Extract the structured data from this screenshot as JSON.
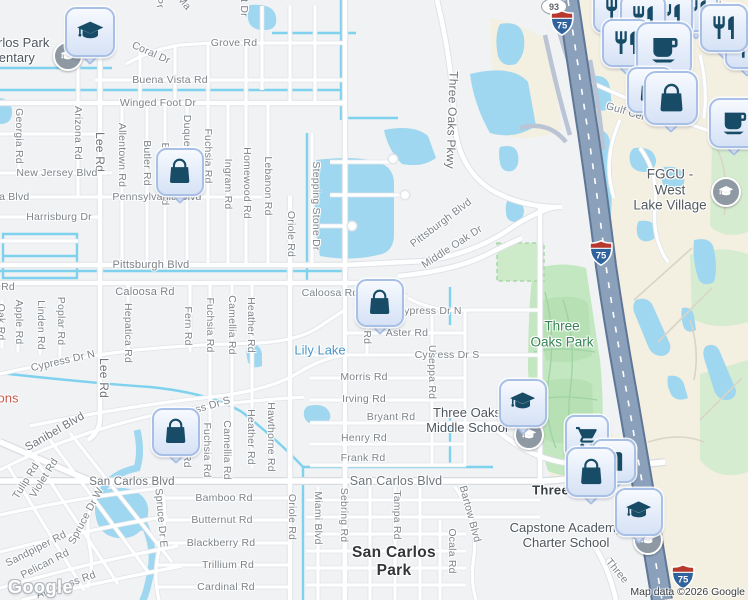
{
  "map": {
    "attribution": "Map data ©2026 Google",
    "watermark": "Google",
    "colors": {
      "land": "#f0f2f4",
      "commercial": "#f3efe1",
      "water": "#9ed7ef",
      "canal": "#7fd2ee",
      "park": "#c3e7c0",
      "golf": "#d6ecd0",
      "highway": "#8ba0ba",
      "highway_edge": "#5f7796",
      "pin_bg": "#e4ecfa",
      "pin_border": "#a9c0e6",
      "pin_icon": "#174b66",
      "road_label": "#7d848a",
      "park_label": "#3a8257",
      "water_label": "#4a96c8"
    },
    "place_labels": [
      {
        "name": "san-carlos-park-elementary-label",
        "lines": [
          "San Carlos Park",
          "Elementary"
        ],
        "x": 2,
        "y": 51,
        "color": "#4e565e",
        "size": 13
      },
      {
        "name": "fgcu-west-lake-village-label",
        "lines": [
          "FGCU - West",
          "Lake Village"
        ],
        "x": 670,
        "y": 190,
        "color": "#545b61",
        "size": 13.5
      },
      {
        "name": "three-oaks-park-label",
        "lines": [
          "Three",
          "Oaks Park"
        ],
        "x": 562,
        "y": 334,
        "color": "#3a8257",
        "size": 13.5
      },
      {
        "name": "lily-lake-label",
        "lines": [
          "Lily Lake"
        ],
        "x": 320,
        "y": 351,
        "color": "#4a96c8",
        "size": 13
      },
      {
        "name": "three-oaks-middle-school-label",
        "lines": [
          "Three Oaks",
          "Middle School"
        ],
        "x": 467,
        "y": 421,
        "color": "#4e565e",
        "size": 13
      },
      {
        "name": "capstone-academy-charter-school-label",
        "lines": [
          "Capstone Academy",
          "Charter School"
        ],
        "x": 566,
        "y": 536,
        "color": "#4e565e",
        "size": 13
      },
      {
        "name": "three-oaks-label",
        "lines": [
          "Three Oaks"
        ],
        "x": 569,
        "y": 491,
        "color": "#393e42",
        "size": 13,
        "bold": true
      },
      {
        "name": "san-carlos-park-city-label",
        "lines": [
          "San Carlos",
          "Park"
        ],
        "x": 394,
        "y": 562,
        "color": "#323639",
        "size": 15.5,
        "bold": true
      },
      {
        "name": "poi-fragment-label",
        "lines": [
          "ons"
        ],
        "x": 8,
        "y": 399,
        "color": "#c8574c",
        "size": 13
      }
    ],
    "road_labels": [
      {
        "text": "Grove Rd",
        "x": 234,
        "y": 43
      },
      {
        "text": "Coral Dr",
        "x": 151,
        "y": 53,
        "r": 24
      },
      {
        "text": "Buena Vista Rd",
        "x": 170,
        "y": 80
      },
      {
        "text": "Winged Foot Dr",
        "x": 158,
        "y": 103
      },
      {
        "text": "Georgia Rd",
        "x": 19,
        "y": 136,
        "r": 90
      },
      {
        "text": "Arizona Rd",
        "x": 78,
        "y": 133,
        "r": 90
      },
      {
        "text": "Lee Rd",
        "x": 100,
        "y": 152,
        "r": 90,
        "size": 12,
        "major": true
      },
      {
        "text": "Allentown Rd",
        "x": 122,
        "y": 155,
        "r": 90
      },
      {
        "text": "Butler Rd",
        "x": 147,
        "y": 163,
        "r": 90
      },
      {
        "text": "Braddock Rd",
        "x": 165,
        "y": 174,
        "r": 90
      },
      {
        "text": "Duquesne Rd",
        "x": 187,
        "y": 148,
        "r": 90
      },
      {
        "text": "Fuchsia Rd",
        "x": 208,
        "y": 156,
        "r": 90
      },
      {
        "text": "Ingram Rd",
        "x": 228,
        "y": 184,
        "r": 90
      },
      {
        "text": "Homewood Rd",
        "x": 247,
        "y": 183,
        "r": 90
      },
      {
        "text": "Lebanon Rd",
        "x": 268,
        "y": 186,
        "r": 90
      },
      {
        "text": "Oriole Rd",
        "x": 291,
        "y": 234,
        "r": 90
      },
      {
        "text": "Stepping Stone Dr",
        "x": 316,
        "y": 206,
        "r": 90
      },
      {
        "text": "Three Oaks Pkwy",
        "x": 452,
        "y": 120,
        "r": 92,
        "size": 12,
        "major": true
      },
      {
        "text": "New Jersey Blvd",
        "x": 57,
        "y": 173
      },
      {
        "text": "ia Blvd",
        "x": 13,
        "y": 197
      },
      {
        "text": "Pennsylvania Blvd",
        "x": 157,
        "y": 197
      },
      {
        "text": "Harrisburg Dr",
        "x": 59,
        "y": 217
      },
      {
        "text": "Pittsburgh Blvd",
        "x": 151,
        "y": 265,
        "size": 11
      },
      {
        "text": "Pittsburgh Blvd",
        "x": 441,
        "y": 223,
        "r": -37
      },
      {
        "text": "Middle Oak Dr",
        "x": 452,
        "y": 247,
        "r": -33
      },
      {
        "text": "Rd",
        "x": 8,
        "y": 287
      },
      {
        "text": "Caloosa Rd",
        "x": 145,
        "y": 292,
        "size": 11
      },
      {
        "text": "Caloosa Rd",
        "x": 330,
        "y": 293
      },
      {
        "text": "Oak Rd",
        "x": 1,
        "y": 322,
        "r": 90
      },
      {
        "text": "Apple Rd",
        "x": 19,
        "y": 322,
        "r": 90
      },
      {
        "text": "Linden Rd",
        "x": 41,
        "y": 325,
        "r": 90
      },
      {
        "text": "Poplar Rd",
        "x": 61,
        "y": 321,
        "r": 90
      },
      {
        "text": "Hepatica Rd",
        "x": 128,
        "y": 333,
        "r": 90
      },
      {
        "text": "Fern Rd",
        "x": 188,
        "y": 326,
        "r": 90
      },
      {
        "text": "Fuchsia Rd",
        "x": 210,
        "y": 325,
        "r": 90
      },
      {
        "text": "Camellia Rd",
        "x": 232,
        "y": 325,
        "r": 90
      },
      {
        "text": "Heather Rd",
        "x": 251,
        "y": 325,
        "r": 90
      },
      {
        "text": "Lee Rd",
        "x": 104,
        "y": 378,
        "r": 90,
        "size": 12,
        "major": true
      },
      {
        "text": "Cypress Dr N",
        "x": 63,
        "y": 361,
        "r": -13
      },
      {
        "text": "Cypress Dr N",
        "x": 429,
        "y": 311
      },
      {
        "text": "Aster Rd",
        "x": 407,
        "y": 333
      },
      {
        "text": "Aster Rd",
        "x": 367,
        "y": 323,
        "r": 90
      },
      {
        "text": "Cypress Dr S",
        "x": 447,
        "y": 355
      },
      {
        "text": "Cypress Dr S",
        "x": 199,
        "y": 409,
        "r": -16
      },
      {
        "text": "Morris Rd",
        "x": 364,
        "y": 377
      },
      {
        "text": "Irving Rd",
        "x": 364,
        "y": 399
      },
      {
        "text": "Bryant Rd",
        "x": 391,
        "y": 417
      },
      {
        "text": "Henry Rd",
        "x": 364,
        "y": 438
      },
      {
        "text": "Frank Rd",
        "x": 363,
        "y": 458
      },
      {
        "text": "Useppa Rd",
        "x": 432,
        "y": 372,
        "r": 90
      },
      {
        "text": "Sanibel Blvd",
        "x": 55,
        "y": 432,
        "r": -30,
        "size": 11.5,
        "major": true
      },
      {
        "text": "San Carlos Blvd",
        "x": 132,
        "y": 482,
        "size": 11.5,
        "major": true
      },
      {
        "text": "San Carlos Blvd",
        "x": 396,
        "y": 481,
        "size": 12.5,
        "major": true
      },
      {
        "text": "Fern Rd",
        "x": 187,
        "y": 448,
        "r": 90
      },
      {
        "text": "Fuchsia Rd",
        "x": 207,
        "y": 450,
        "r": 90
      },
      {
        "text": "Camellia Rd",
        "x": 227,
        "y": 450,
        "r": 90
      },
      {
        "text": "Heather Rd",
        "x": 251,
        "y": 437,
        "r": 90
      },
      {
        "text": "Hawthorne Rd",
        "x": 271,
        "y": 437,
        "r": 90
      },
      {
        "text": "Oriole Rd",
        "x": 292,
        "y": 517,
        "r": 90
      },
      {
        "text": "Miami Blvd",
        "x": 318,
        "y": 518,
        "r": 90
      },
      {
        "text": "Sebring Rd",
        "x": 344,
        "y": 515,
        "r": 90
      },
      {
        "text": "Tampa Rd",
        "x": 397,
        "y": 515,
        "r": 90
      },
      {
        "text": "Bartow Blvd",
        "x": 470,
        "y": 514,
        "r": 75
      },
      {
        "text": "Ocala Rd",
        "x": 452,
        "y": 551,
        "r": 90
      },
      {
        "text": "Spruce Dr W",
        "x": 86,
        "y": 516,
        "r": -62
      },
      {
        "text": "Spruce Dr E",
        "x": 161,
        "y": 518,
        "r": 85
      },
      {
        "text": "Bamboo Rd",
        "x": 224,
        "y": 498
      },
      {
        "text": "Butternut Rd",
        "x": 222,
        "y": 520
      },
      {
        "text": "Blackberry Rd",
        "x": 221,
        "y": 543
      },
      {
        "text": "Trillium Rd",
        "x": 228,
        "y": 565
      },
      {
        "text": "Cardinal Rd",
        "x": 226,
        "y": 587
      },
      {
        "text": "Sandpiper Rd",
        "x": 36,
        "y": 549,
        "r": -27
      },
      {
        "text": "Pelican Rd",
        "x": 45,
        "y": 564,
        "r": -27
      },
      {
        "text": "Albatross Rd",
        "x": 66,
        "y": 585,
        "r": -20
      },
      {
        "text": "Violet Rd",
        "x": 44,
        "y": 478,
        "r": -58
      },
      {
        "text": "Tulip Rd",
        "x": 26,
        "y": 481,
        "r": -58
      },
      {
        "text": "Gulf Center Dr",
        "x": 640,
        "y": 116,
        "r": 17
      },
      {
        "text": "Center Dr",
        "x": 722,
        "y": 5,
        "r": 10
      },
      {
        "text": "Three",
        "x": 617,
        "y": 571,
        "r": 50
      },
      {
        "text": "t Dr",
        "x": 244,
        "y": 8,
        "r": 90
      },
      {
        "text": "Pr",
        "x": 159,
        "y": 3,
        "r": 75
      },
      {
        "text": "Ma",
        "x": 184,
        "y": 3,
        "r": 50
      }
    ],
    "pins": [
      {
        "icon": "graduation-cap",
        "x": 88,
        "y": 30,
        "s": 46
      },
      {
        "icon": "shopping-bag",
        "x": 178,
        "y": 170,
        "s": 44
      },
      {
        "icon": "shopping-bag",
        "x": 378,
        "y": 301,
        "s": 44
      },
      {
        "icon": "shopping-bag",
        "x": 174,
        "y": 430,
        "s": 44
      },
      {
        "icon": "graduation-cap",
        "x": 521,
        "y": 401,
        "s": 44
      },
      {
        "icon": "graduation-cap",
        "x": 637,
        "y": 510,
        "s": 44
      },
      {
        "icon": "restaurant",
        "x": 614,
        "y": 8,
        "s": 42
      },
      {
        "icon": "restaurant",
        "x": 694,
        "y": 8,
        "s": 40
      },
      {
        "icon": "restaurant",
        "x": 668,
        "y": 13,
        "s": 42
      },
      {
        "icon": "restaurant",
        "x": 641,
        "y": 15,
        "s": 42
      },
      {
        "icon": "restaurant",
        "x": 745,
        "y": 45,
        "s": 40
      },
      {
        "icon": "restaurant",
        "x": 722,
        "y": 26,
        "s": 44
      },
      {
        "icon": "restaurant",
        "x": 624,
        "y": 41,
        "s": 44
      },
      {
        "icon": "coffee",
        "x": 662,
        "y": 48,
        "s": 52
      },
      {
        "icon": "shopping-bag",
        "x": 648,
        "y": 88,
        "s": 42
      },
      {
        "icon": "shopping-bag",
        "x": 669,
        "y": 96,
        "s": 50
      },
      {
        "icon": "coffee",
        "x": 732,
        "y": 121,
        "s": 46
      },
      {
        "icon": "shopping-cart",
        "x": 585,
        "y": 435,
        "s": 40
      },
      {
        "icon": "store",
        "x": 612,
        "y": 459,
        "s": 40
      },
      {
        "icon": "shopping-bag",
        "x": 589,
        "y": 470,
        "s": 46
      }
    ],
    "shields": [
      {
        "style": "oval",
        "text": "93",
        "x": 553,
        "y": 5
      },
      {
        "style": "interstate",
        "text": "75",
        "x": 562,
        "y": 23
      },
      {
        "style": "interstate",
        "text": "75",
        "x": 601,
        "y": 253
      },
      {
        "style": "interstate",
        "text": "75",
        "x": 683,
        "y": 577
      }
    ],
    "poi_circles": [
      {
        "icon": "graduation-cap",
        "x": 66,
        "y": 54
      },
      {
        "icon": "graduation-cap",
        "x": 724,
        "y": 190
      },
      {
        "icon": "graduation-cap",
        "x": 527,
        "y": 433
      },
      {
        "icon": "graduation-cap",
        "x": 646,
        "y": 538
      }
    ]
  }
}
